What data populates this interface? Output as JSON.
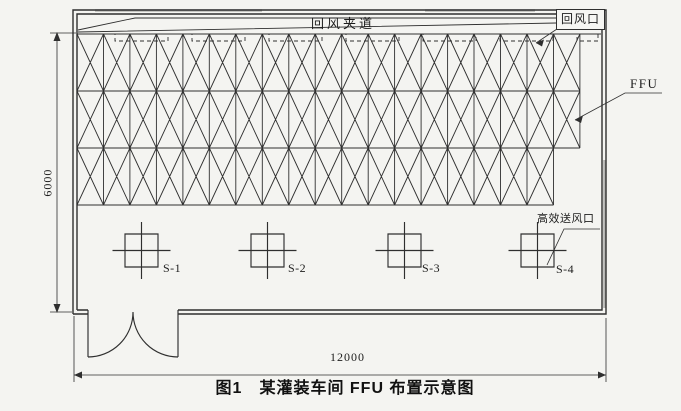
{
  "figure": {
    "caption": "图1　某灌装车间 FFU 布置示意图",
    "dim_height_label": "6000",
    "dim_width_label": "12000"
  },
  "labels": {
    "return_air_passage": "回风夹道",
    "return_air_outlet": "回风口",
    "ffu": "FFU",
    "hepa_supply_outlet": "高效送风口",
    "supply_points": [
      "S-1",
      "S-2",
      "S-3",
      "S-4"
    ]
  },
  "drawing": {
    "canvas": {
      "w": 681,
      "h": 411
    },
    "room": {
      "outer": [
        73,
        10,
        606,
        314
      ],
      "inner": [
        77,
        14,
        602,
        310
      ]
    },
    "ffu_grid": {
      "x": 77,
      "y": 34,
      "col_w": 26.47,
      "row_h": 57,
      "rows_cols": [
        19,
        19,
        18
      ],
      "top_line_right": 601
    },
    "return_openings": {
      "y": 34,
      "h": 7,
      "items": [
        [
          115,
          53
        ],
        [
          192,
          53
        ],
        [
          269,
          53
        ],
        [
          346,
          53
        ],
        [
          423,
          53
        ],
        [
          500,
          53
        ],
        [
          577,
          21
        ]
      ]
    },
    "supply_outlets": {
      "cx": [
        141.5,
        267.5,
        404.5,
        537.5
      ],
      "cy": 250.5,
      "size": 33,
      "h_half": 29,
      "v_half": 28.5
    },
    "door": {
      "jambs": [
        88,
        178
      ],
      "sill_y": 310,
      "swing_bottom": 357,
      "radius": 45
    },
    "colors": {
      "ink": "#2f2f2f",
      "paper": "#f4f4f1"
    }
  }
}
